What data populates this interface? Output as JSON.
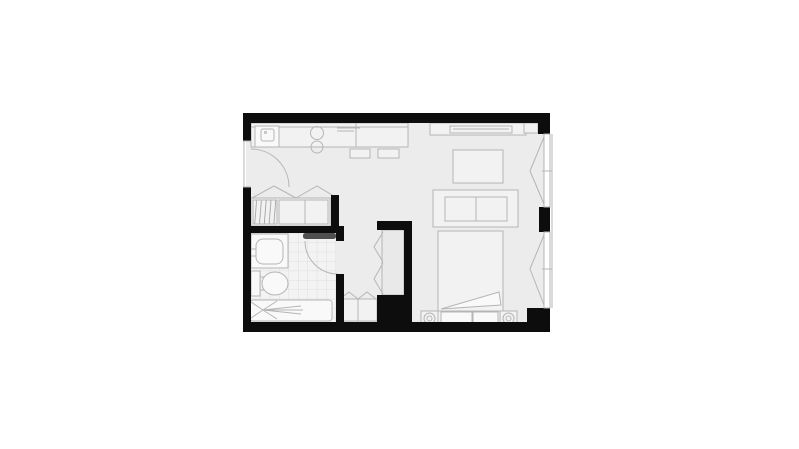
{
  "window": {
    "width_px": 799,
    "height_px": 449
  },
  "colors": {
    "background": "#ffffff",
    "wall": "#0d0d0d",
    "floor": "#ececec",
    "bath_floor": "#f3f3f3",
    "tile": "#d9d9d9",
    "line": "#b5b5b5",
    "furniture": "#f2f2f2",
    "fixture": "#f9f9f9",
    "stripe": "#9a9a9a",
    "door_leaf": "#4f4f4f",
    "glazing": "#ffffff"
  },
  "plan": {
    "kind": "studio-apartment-floor-plan",
    "rooms": [
      "kitchen-living-area",
      "bedroom-area",
      "bathroom",
      "entry-hall",
      "closet",
      "wardrobe-niche",
      "corridor"
    ],
    "fixtures": [
      "entry-door",
      "kitchen-counter",
      "kitchen-sink",
      "hob-burners",
      "counter-shelf",
      "bar-stools",
      "closet-bifold-doors",
      "closet-shelves",
      "bathroom-door",
      "bathroom-sink",
      "toilet",
      "shower-tray",
      "tiled-floor",
      "hanging-wardrobe",
      "corridor-cabinet",
      "desk-shelf",
      "tv-table",
      "sofa-bench",
      "double-bed",
      "bed-headboard",
      "pillows",
      "bed-casters",
      "right-wall-windows"
    ]
  }
}
